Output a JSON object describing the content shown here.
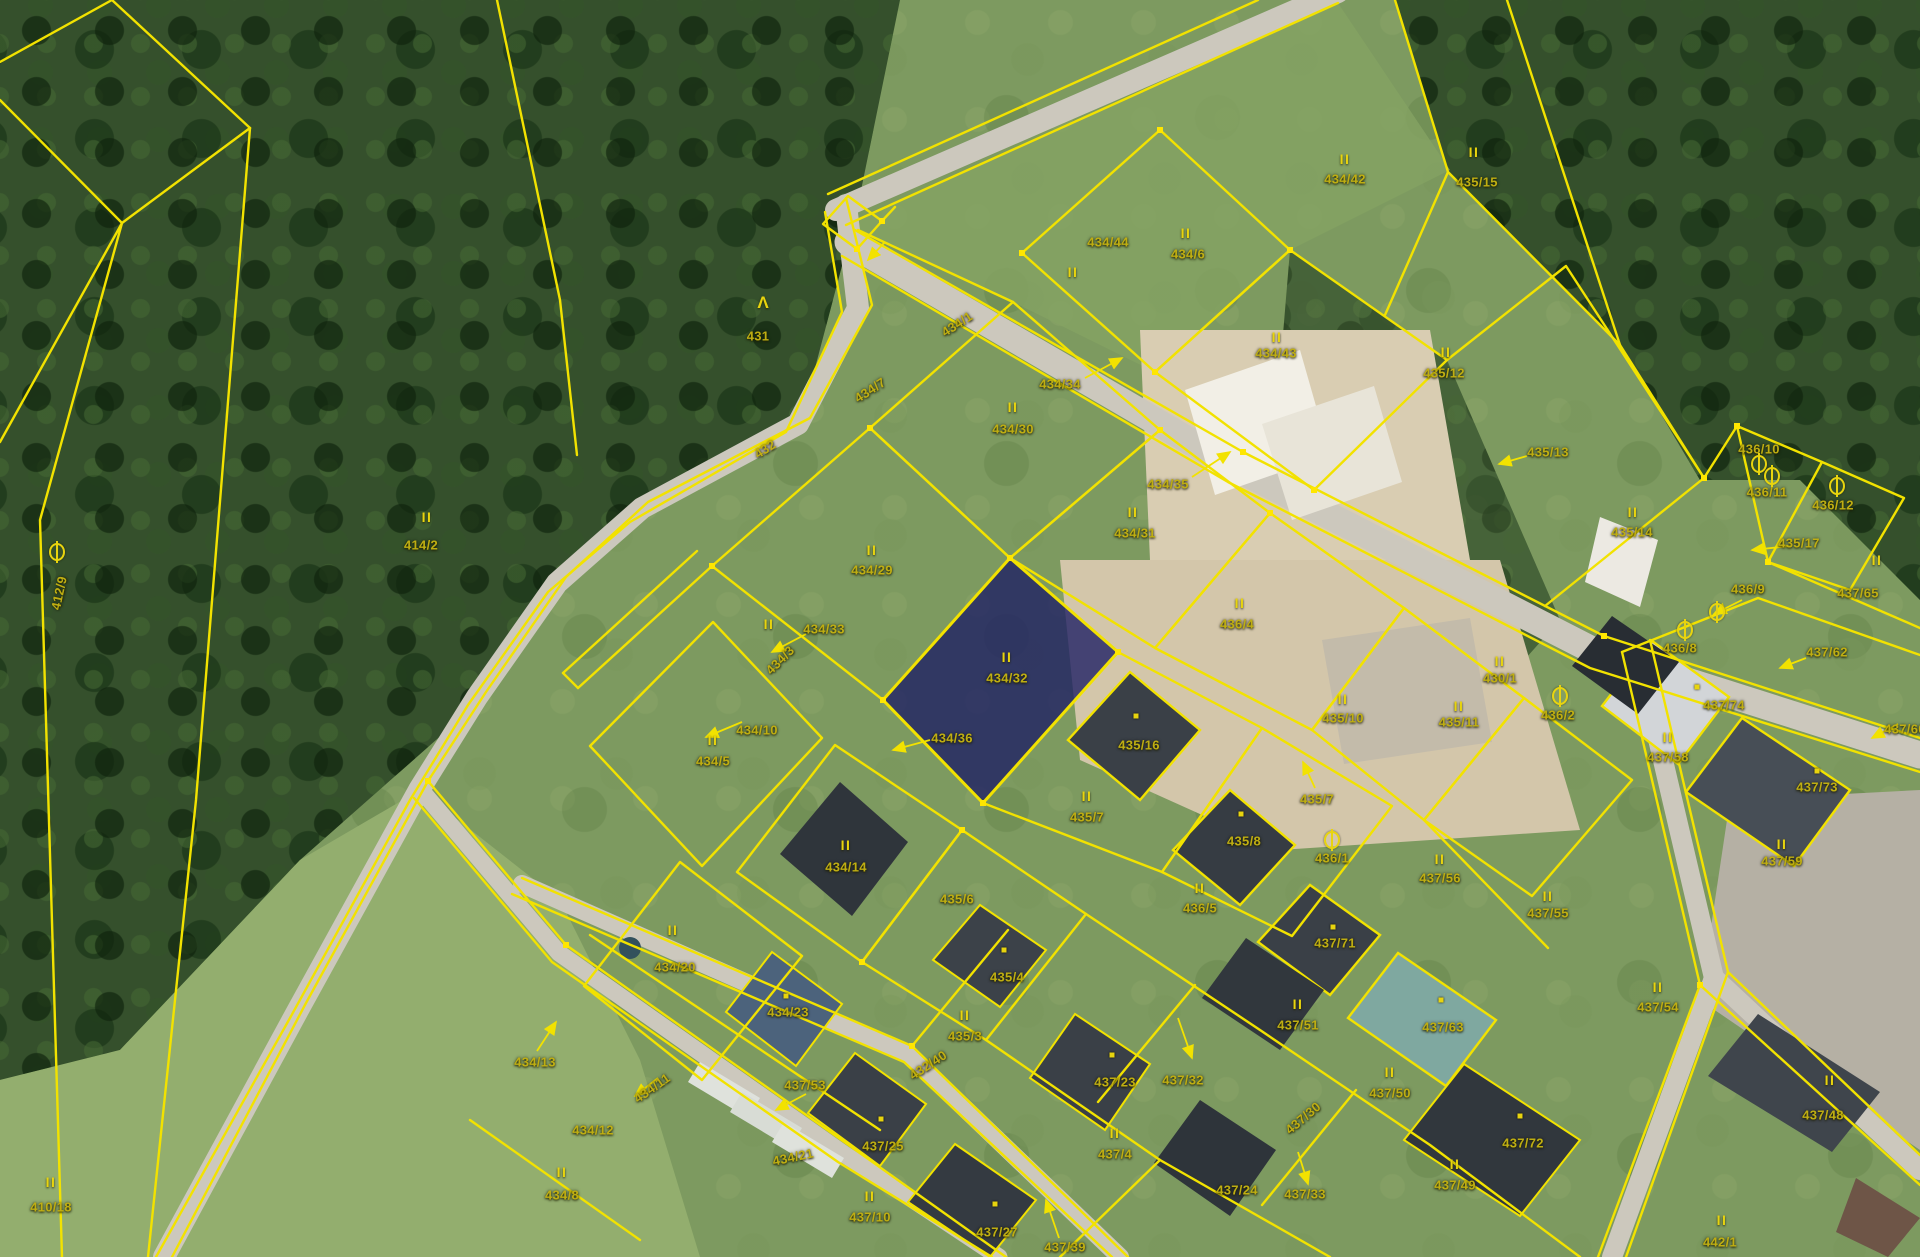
{
  "map": {
    "type": "cadastral-orthophoto",
    "selected_parcel": "434/32",
    "colors": {
      "parcel_line": "#f2e200",
      "label": "#bfae12",
      "symbol": "#e8d40e",
      "highlight_fill": "#1c1c64",
      "road": "#ccc8bd"
    },
    "glyphs": {
      "ii": "II",
      "tree": "Λ"
    },
    "labels": [
      {
        "t": "431",
        "x": 758,
        "y": 336
      },
      {
        "t": "414/2",
        "x": 421,
        "y": 545
      },
      {
        "t": "412/9",
        "x": 59,
        "y": 593,
        "r": -78
      },
      {
        "t": "410/18",
        "x": 51,
        "y": 1207
      },
      {
        "t": "434/44",
        "x": 1108,
        "y": 242
      },
      {
        "t": "434/6",
        "x": 1188,
        "y": 254
      },
      {
        "t": "434/42",
        "x": 1345,
        "y": 179
      },
      {
        "t": "435/15",
        "x": 1477,
        "y": 182
      },
      {
        "t": "434/43",
        "x": 1276,
        "y": 353
      },
      {
        "t": "435/12",
        "x": 1444,
        "y": 373
      },
      {
        "t": "434/1",
        "x": 957,
        "y": 324,
        "r": -33
      },
      {
        "t": "434/7",
        "x": 870,
        "y": 390,
        "r": -33
      },
      {
        "t": "432",
        "x": 765,
        "y": 449,
        "r": -33
      },
      {
        "t": "434/3",
        "x": 780,
        "y": 660,
        "r": -45
      },
      {
        "t": "434/34",
        "x": 1060,
        "y": 384
      },
      {
        "t": "434/30",
        "x": 1013,
        "y": 429
      },
      {
        "t": "434/35",
        "x": 1168,
        "y": 484
      },
      {
        "t": "434/31",
        "x": 1135,
        "y": 533
      },
      {
        "t": "434/29",
        "x": 872,
        "y": 570
      },
      {
        "t": "434/33",
        "x": 824,
        "y": 629
      },
      {
        "t": "434/32",
        "x": 1007,
        "y": 678
      },
      {
        "t": "434/36",
        "x": 952,
        "y": 738
      },
      {
        "t": "434/10",
        "x": 757,
        "y": 730
      },
      {
        "t": "434/5",
        "x": 713,
        "y": 761
      },
      {
        "t": "435/16",
        "x": 1139,
        "y": 745
      },
      {
        "t": "435/7",
        "x": 1087,
        "y": 817
      },
      {
        "t": "436/4",
        "x": 1237,
        "y": 624
      },
      {
        "t": "435/10",
        "x": 1343,
        "y": 718
      },
      {
        "t": "435/11",
        "x": 1459,
        "y": 722
      },
      {
        "t": "430/1",
        "x": 1500,
        "y": 678
      },
      {
        "t": "436/2",
        "x": 1558,
        "y": 715
      },
      {
        "t": "435/14",
        "x": 1632,
        "y": 532
      },
      {
        "t": "435/13",
        "x": 1548,
        "y": 452
      },
      {
        "t": "436/10",
        "x": 1759,
        "y": 449
      },
      {
        "t": "436/11",
        "x": 1767,
        "y": 492
      },
      {
        "t": "436/12",
        "x": 1833,
        "y": 505
      },
      {
        "t": "435/17",
        "x": 1799,
        "y": 543
      },
      {
        "t": "437/65",
        "x": 1858,
        "y": 593
      },
      {
        "t": "436/9",
        "x": 1748,
        "y": 589
      },
      {
        "t": "436/8",
        "x": 1680,
        "y": 648
      },
      {
        "t": "437/62",
        "x": 1827,
        "y": 652
      },
      {
        "t": "437/74",
        "x": 1724,
        "y": 705
      },
      {
        "t": "437/58",
        "x": 1668,
        "y": 757
      },
      {
        "t": "437/73",
        "x": 1817,
        "y": 787
      },
      {
        "t": "437/59",
        "x": 1782,
        "y": 861
      },
      {
        "t": "437/60",
        "x": 1905,
        "y": 729
      },
      {
        "t": "437/56",
        "x": 1440,
        "y": 878
      },
      {
        "t": "437/55",
        "x": 1548,
        "y": 913
      },
      {
        "t": "435/7",
        "x": 1317,
        "y": 799
      },
      {
        "t": "436/1",
        "x": 1332,
        "y": 858
      },
      {
        "t": "435/8",
        "x": 1244,
        "y": 841
      },
      {
        "t": "436/5",
        "x": 1200,
        "y": 908
      },
      {
        "t": "437/71",
        "x": 1335,
        "y": 943
      },
      {
        "t": "434/14",
        "x": 846,
        "y": 867
      },
      {
        "t": "435/6",
        "x": 957,
        "y": 899
      },
      {
        "t": "434/20",
        "x": 675,
        "y": 967
      },
      {
        "t": "434/23",
        "x": 788,
        "y": 1012
      },
      {
        "t": "435/4",
        "x": 1007,
        "y": 977
      },
      {
        "t": "435/3",
        "x": 965,
        "y": 1036
      },
      {
        "t": "437/53",
        "x": 805,
        "y": 1085
      },
      {
        "t": "434/13",
        "x": 535,
        "y": 1062
      },
      {
        "t": "434/11",
        "x": 652,
        "y": 1088,
        "r": -35
      },
      {
        "t": "434/12",
        "x": 593,
        "y": 1130
      },
      {
        "t": "434/8",
        "x": 562,
        "y": 1195
      },
      {
        "t": "434/21",
        "x": 793,
        "y": 1157,
        "r": -12
      },
      {
        "t": "432/40",
        "x": 928,
        "y": 1065,
        "r": -33
      },
      {
        "t": "437/25",
        "x": 883,
        "y": 1146
      },
      {
        "t": "437/10",
        "x": 870,
        "y": 1217
      },
      {
        "t": "437/27",
        "x": 997,
        "y": 1232
      },
      {
        "t": "437/39",
        "x": 1065,
        "y": 1247
      },
      {
        "t": "437/23",
        "x": 1115,
        "y": 1082
      },
      {
        "t": "437/32",
        "x": 1183,
        "y": 1080
      },
      {
        "t": "437/4",
        "x": 1115,
        "y": 1154
      },
      {
        "t": "437/24",
        "x": 1237,
        "y": 1190
      },
      {
        "t": "437/51",
        "x": 1298,
        "y": 1025
      },
      {
        "t": "437/63",
        "x": 1443,
        "y": 1027
      },
      {
        "t": "437/50",
        "x": 1390,
        "y": 1093
      },
      {
        "t": "437/54",
        "x": 1658,
        "y": 1007
      },
      {
        "t": "437/72",
        "x": 1523,
        "y": 1143
      },
      {
        "t": "437/49",
        "x": 1455,
        "y": 1185
      },
      {
        "t": "437/33",
        "x": 1305,
        "y": 1194
      },
      {
        "t": "437/30",
        "x": 1303,
        "y": 1118,
        "r": -40
      },
      {
        "t": "437/48",
        "x": 1823,
        "y": 1115
      },
      {
        "t": "442/1",
        "x": 1720,
        "y": 1242
      }
    ],
    "symbols": [
      {
        "k": "tree",
        "x": 763,
        "y": 303
      },
      {
        "k": "obar",
        "x": 57,
        "y": 552
      },
      {
        "k": "obar",
        "x": 1759,
        "y": 464
      },
      {
        "k": "obar",
        "x": 1772,
        "y": 476
      },
      {
        "k": "obar",
        "x": 1837,
        "y": 486
      },
      {
        "k": "obar",
        "x": 1717,
        "y": 612
      },
      {
        "k": "obar",
        "x": 1685,
        "y": 630
      },
      {
        "k": "obar",
        "x": 1560,
        "y": 696
      },
      {
        "k": "obar",
        "x": 1332,
        "y": 840
      },
      {
        "k": "ii",
        "x": 427,
        "y": 517
      },
      {
        "k": "ii",
        "x": 1186,
        "y": 233
      },
      {
        "k": "ii",
        "x": 1345,
        "y": 159
      },
      {
        "k": "ii",
        "x": 1474,
        "y": 152
      },
      {
        "k": "ii",
        "x": 1277,
        "y": 337
      },
      {
        "k": "ii",
        "x": 1446,
        "y": 352
      },
      {
        "k": "ii",
        "x": 1013,
        "y": 407
      },
      {
        "k": "ii",
        "x": 1133,
        "y": 512
      },
      {
        "k": "ii",
        "x": 872,
        "y": 550
      },
      {
        "k": "ii",
        "x": 769,
        "y": 624
      },
      {
        "k": "ii",
        "x": 1007,
        "y": 657
      },
      {
        "k": "ii",
        "x": 713,
        "y": 740
      },
      {
        "k": "ii",
        "x": 1087,
        "y": 796
      },
      {
        "k": "ii",
        "x": 1343,
        "y": 699
      },
      {
        "k": "ii",
        "x": 1459,
        "y": 706
      },
      {
        "k": "ii",
        "x": 1240,
        "y": 603
      },
      {
        "k": "ii",
        "x": 1500,
        "y": 661
      },
      {
        "k": "ii",
        "x": 1633,
        "y": 512
      },
      {
        "k": "ii",
        "x": 1877,
        "y": 560
      },
      {
        "k": "ii",
        "x": 1668,
        "y": 737
      },
      {
        "k": "ii",
        "x": 1782,
        "y": 844
      },
      {
        "k": "ii",
        "x": 1440,
        "y": 859
      },
      {
        "k": "ii",
        "x": 1548,
        "y": 896
      },
      {
        "k": "ii",
        "x": 1200,
        "y": 888
      },
      {
        "k": "ii",
        "x": 846,
        "y": 845
      },
      {
        "k": "ii",
        "x": 673,
        "y": 930
      },
      {
        "k": "ii",
        "x": 965,
        "y": 1015
      },
      {
        "k": "ii",
        "x": 562,
        "y": 1172
      },
      {
        "k": "ii",
        "x": 51,
        "y": 1182
      },
      {
        "k": "ii",
        "x": 870,
        "y": 1196
      },
      {
        "k": "ii",
        "x": 1115,
        "y": 1133
      },
      {
        "k": "ii",
        "x": 1298,
        "y": 1004
      },
      {
        "k": "ii",
        "x": 1390,
        "y": 1072
      },
      {
        "k": "ii",
        "x": 1658,
        "y": 987
      },
      {
        "k": "ii",
        "x": 1455,
        "y": 1164
      },
      {
        "k": "ii",
        "x": 1830,
        "y": 1080
      },
      {
        "k": "ii",
        "x": 1722,
        "y": 1220
      },
      {
        "k": "ii",
        "x": 1073,
        "y": 272
      },
      {
        "k": "dot",
        "x": 1136,
        "y": 716
      },
      {
        "k": "dot",
        "x": 1241,
        "y": 814
      },
      {
        "k": "dot",
        "x": 786,
        "y": 996
      },
      {
        "k": "dot",
        "x": 881,
        "y": 1119
      },
      {
        "k": "dot",
        "x": 1112,
        "y": 1055
      },
      {
        "k": "dot",
        "x": 995,
        "y": 1204
      },
      {
        "k": "dot",
        "x": 1441,
        "y": 1000
      },
      {
        "k": "dot",
        "x": 1520,
        "y": 1116
      },
      {
        "k": "dot",
        "x": 1004,
        "y": 950
      },
      {
        "k": "dot",
        "x": 1697,
        "y": 687
      },
      {
        "k": "dot",
        "x": 1817,
        "y": 771
      },
      {
        "k": "dot",
        "x": 1333,
        "y": 927
      }
    ],
    "leaders": [
      {
        "x1": 1085,
        "y1": 378,
        "x2": 1122,
        "y2": 358
      },
      {
        "x1": 1192,
        "y1": 477,
        "x2": 1230,
        "y2": 452
      },
      {
        "x1": 806,
        "y1": 634,
        "x2": 772,
        "y2": 652
      },
      {
        "x1": 930,
        "y1": 740,
        "x2": 893,
        "y2": 750
      },
      {
        "x1": 742,
        "y1": 722,
        "x2": 706,
        "y2": 737
      },
      {
        "x1": 537,
        "y1": 1051,
        "x2": 556,
        "y2": 1022
      },
      {
        "x1": 1790,
        "y1": 546,
        "x2": 1752,
        "y2": 550
      },
      {
        "x1": 1742,
        "y1": 600,
        "x2": 1714,
        "y2": 614
      },
      {
        "x1": 1806,
        "y1": 658,
        "x2": 1780,
        "y2": 668
      },
      {
        "x1": 806,
        "y1": 1094,
        "x2": 776,
        "y2": 1110
      },
      {
        "x1": 1178,
        "y1": 1018,
        "x2": 1192,
        "y2": 1058
      },
      {
        "x1": 1298,
        "y1": 1152,
        "x2": 1308,
        "y2": 1184
      },
      {
        "x1": 1059,
        "y1": 1238,
        "x2": 1046,
        "y2": 1200
      },
      {
        "x1": 1315,
        "y1": 788,
        "x2": 1303,
        "y2": 762
      },
      {
        "x1": 1898,
        "y1": 724,
        "x2": 1872,
        "y2": 738
      },
      {
        "x1": 658,
        "y1": 1078,
        "x2": 635,
        "y2": 1096
      },
      {
        "x1": 884,
        "y1": 243,
        "x2": 868,
        "y2": 260
      },
      {
        "x1": 1527,
        "y1": 456,
        "x2": 1499,
        "y2": 464
      }
    ]
  }
}
